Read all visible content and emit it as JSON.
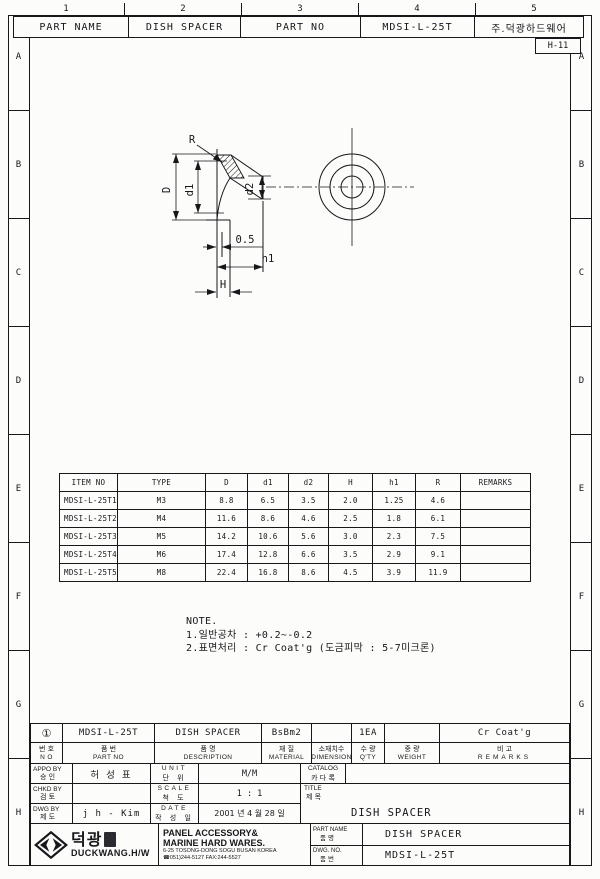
{
  "header": {
    "part_name_label": "PART NAME",
    "part_name_value": "DISH SPACER",
    "part_no_label": "PART NO",
    "part_no_value": "MDSI-L-25T",
    "company": "주.덕광하드웨어",
    "sheet_code": "H-11"
  },
  "frame": {
    "col_labels": [
      "1",
      "2",
      "3",
      "4",
      "5"
    ],
    "row_labels": [
      "A",
      "B",
      "C",
      "D",
      "E",
      "F",
      "G",
      "H"
    ]
  },
  "drawing": {
    "labels": {
      "r": "R",
      "d": "D",
      "d1": "d1",
      "d2": "d2",
      "t": "0.5",
      "h1": "h1",
      "h": "H"
    }
  },
  "spec_table": {
    "headers": [
      "ITEM NO",
      "TYPE",
      "D",
      "d1",
      "d2",
      "H",
      "h1",
      "R",
      "REMARKS"
    ],
    "rows": [
      [
        "MDSI-L-25T1",
        "M3",
        "8.8",
        "6.5",
        "3.5",
        "2.0",
        "1.25",
        "4.6",
        ""
      ],
      [
        "MDSI-L-25T2",
        "M4",
        "11.6",
        "8.6",
        "4.6",
        "2.5",
        "1.8",
        "6.1",
        ""
      ],
      [
        "MDSI-L-25T3",
        "M5",
        "14.2",
        "10.6",
        "5.6",
        "3.0",
        "2.3",
        "7.5",
        ""
      ],
      [
        "MDSI-L-25T4",
        "M6",
        "17.4",
        "12.8",
        "6.6",
        "3.5",
        "2.9",
        "9.1",
        ""
      ],
      [
        "MDSI-L-25T5",
        "M8",
        "22.4",
        "16.8",
        "8.6",
        "4.5",
        "3.9",
        "11.9",
        ""
      ]
    ]
  },
  "note": {
    "title": "NOTE.",
    "lines": [
      "1.일반공차 : +0.2~-0.2",
      "2.표면처리 : Cr Coat'g (도금피막 : 5-7미크론)"
    ]
  },
  "title_block": {
    "item_row": {
      "no": "①",
      "part_no": "MDSI-L-25T",
      "description": "DISH SPACER",
      "material": "BsBm2",
      "dimension": "",
      "qty": "1EA",
      "weight": "",
      "remarks": "Cr Coat'g"
    },
    "item_headers": [
      {
        "kr": "번 호",
        "en": "N O"
      },
      {
        "kr": "품  번",
        "en": "PART  NO"
      },
      {
        "kr": "품  명",
        "en": "DESCRIPTION"
      },
      {
        "kr": "재  질",
        "en": "MATERIAL"
      },
      {
        "kr": "소재치수",
        "en": "DIMENSION"
      },
      {
        "kr": "수 량",
        "en": "Q'TY"
      },
      {
        "kr": "중  량",
        "en": "WEIGHT"
      },
      {
        "kr": "비  고",
        "en": "REMARKS"
      }
    ],
    "sign_rows": [
      {
        "en": "APPO BY",
        "kr": "승 인",
        "value": "허 성 표"
      },
      {
        "en": "CHKD BY",
        "kr": "검 토",
        "value": ""
      },
      {
        "en": "DWG BY",
        "kr": "제 도",
        "value": "j h - Kim"
      }
    ],
    "meta_rows": [
      {
        "en": "UNIT",
        "kr": "단 위",
        "value": "M/M"
      },
      {
        "en": "SCALE",
        "kr": "척 도",
        "value": "1 : 1"
      },
      {
        "en": "DATE",
        "kr": "작 성 일",
        "value": "2001 년 4 월 28 일"
      }
    ],
    "catalog": {
      "en": "CATALOG",
      "kr": "카 다 록",
      "value": ""
    },
    "title": {
      "en": "TITLE",
      "kr": "제 목",
      "value": "DISH SPACER"
    },
    "company": {
      "name_kr": "덕광",
      "name_en": "DUCKWANG.H/W",
      "line1": "PANEL ACCESSORY&",
      "line2": "MARINE HARD WARES.",
      "address": "6-25 TOSONG-DONG SOGU BUSAN KOREA",
      "tel": "☎051)244-5127 FAX:244-5527"
    },
    "footer_rows": [
      {
        "en": "PART NAME",
        "kr": "품  명",
        "value": "DISH SPACER"
      },
      {
        "en": "DWG. NO.",
        "kr": "품  번",
        "value": "MDSI-L-25T"
      }
    ]
  }
}
